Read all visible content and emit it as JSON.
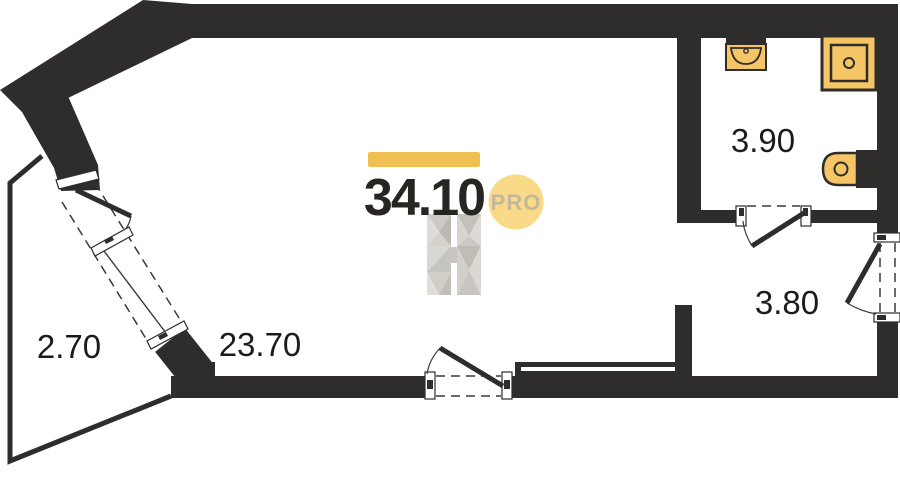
{
  "floorplan": {
    "total_area": "34.10",
    "pro_badge": "PRO",
    "watermark": "H-logo",
    "rooms": [
      {
        "name": "balcony",
        "area": "2.70"
      },
      {
        "name": "living-room",
        "area": "23.70"
      },
      {
        "name": "bathroom",
        "area": "3.90"
      },
      {
        "name": "hallway",
        "area": "3.80"
      }
    ],
    "fixtures": [
      "sink-icon",
      "shower-icon",
      "toilet-icon"
    ],
    "colors": {
      "wall": "#2e2d2c",
      "accent_bar": "#f0c053",
      "pro_circle": "#f8da88",
      "pro_text": "#c4b89b",
      "fixture_fill": "#f5c566",
      "label_text": "#1b1b1b"
    }
  }
}
